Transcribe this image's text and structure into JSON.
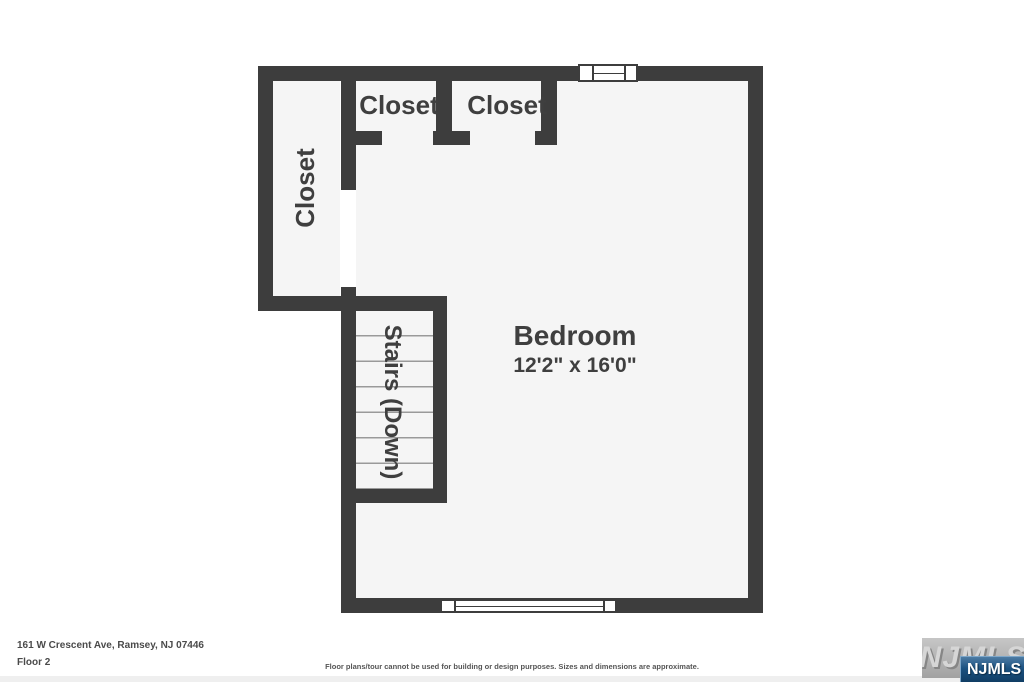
{
  "plan": {
    "rooms": {
      "bedroom": {
        "label": "Bedroom",
        "dimensions": "12'2\" x 16'0\""
      },
      "closet_left": {
        "label": "Closet"
      },
      "closet_top_1": {
        "label": "Closet"
      },
      "closet_top_2": {
        "label": "Closet"
      },
      "stairs": {
        "label": "Stairs (Down)"
      }
    }
  },
  "footer": {
    "address": "161 W Crescent Ave, Ramsey, NJ 07446",
    "floor_label": "Floor 2",
    "disclaimer": "Floor plans/tour cannot be used for building or design purposes. Sizes and dimensions are approximate."
  },
  "watermark": {
    "background_text": "NJMLS",
    "badge_text": "NJMLS"
  },
  "colors": {
    "wall": "#3d3d3d",
    "floor": "#f5f5f5",
    "tread_line": "#9a9a9a",
    "label_text": "#3f3f3f",
    "badge_blue": "#1b5180",
    "watermark_gray": "#b4b4b4"
  }
}
